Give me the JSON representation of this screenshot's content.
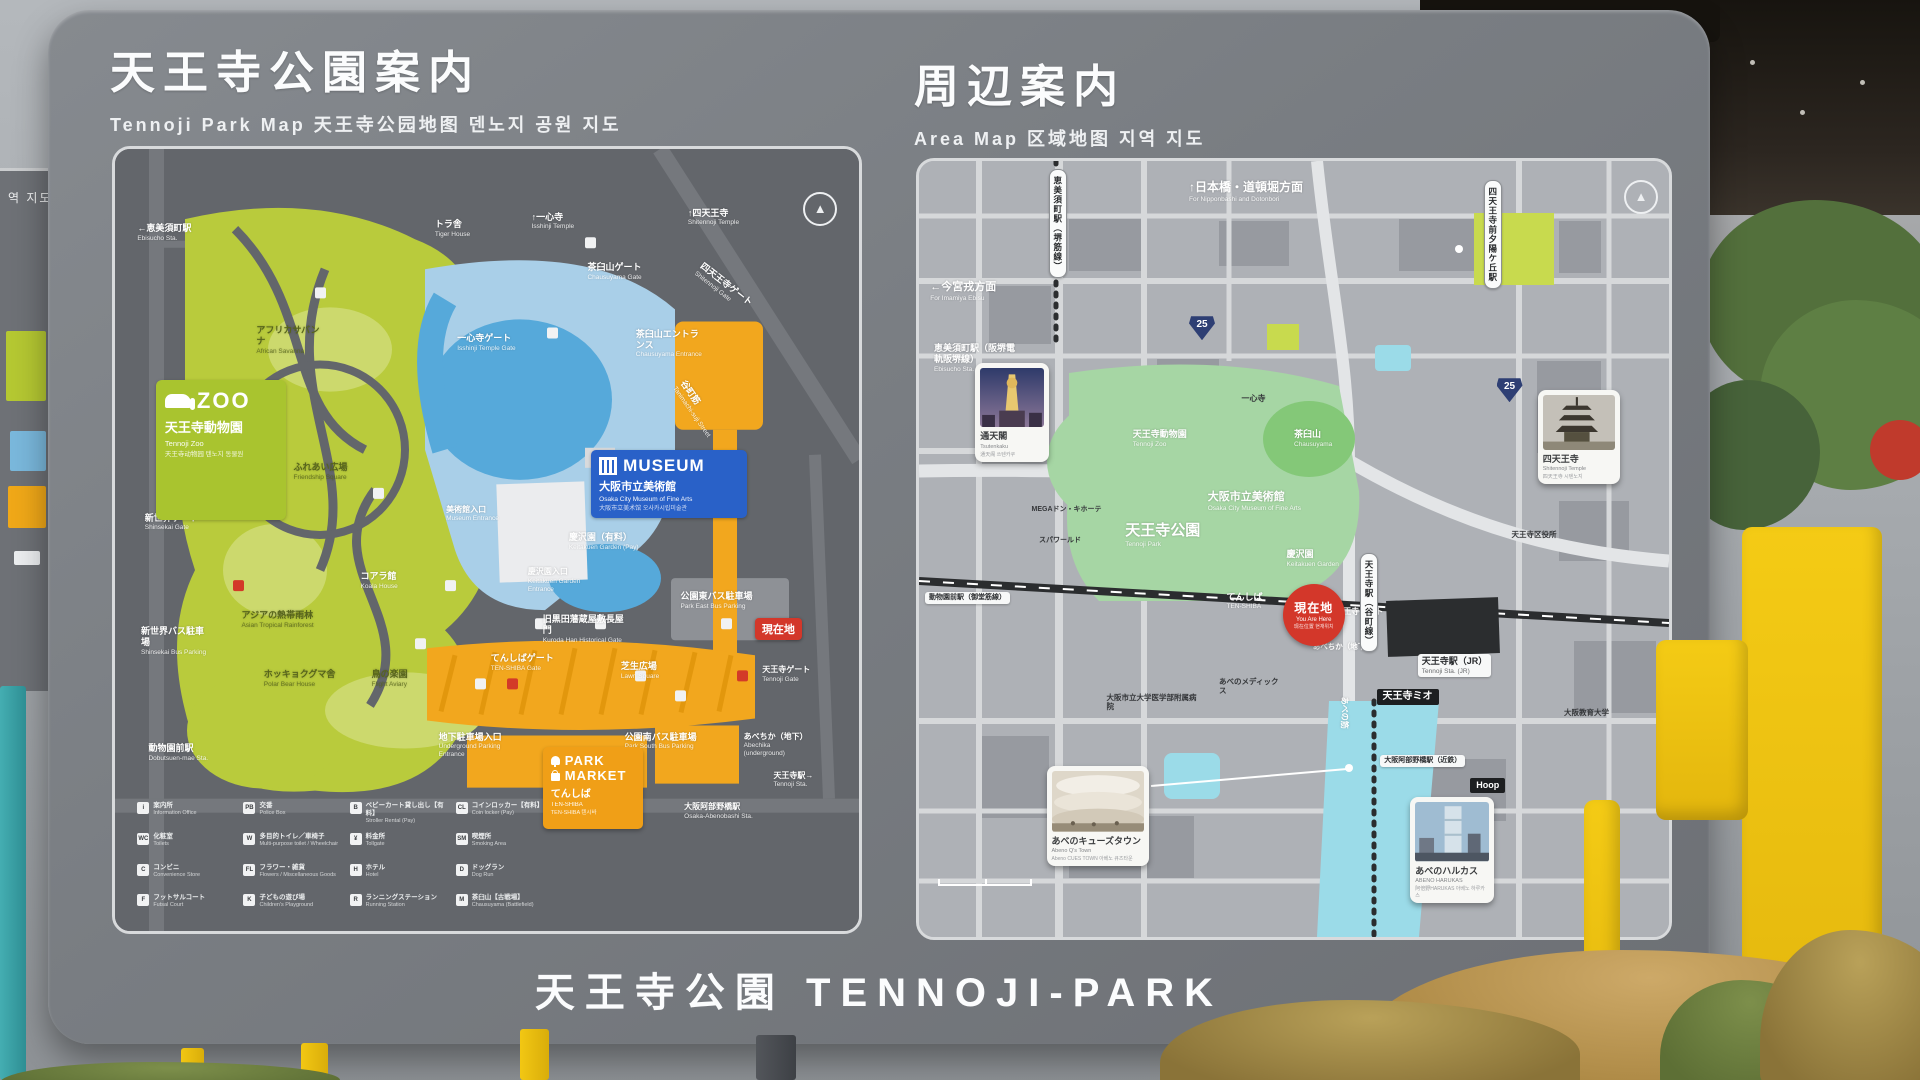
{
  "scene": {
    "left_fragment_text": "역 지도"
  },
  "board": {
    "footer": "天王寺公園  TENNOJI-PARK",
    "left": {
      "title": "天王寺公園案内",
      "subtitle": "Tennoji Park Map  天王寺公园地图  덴노지 공원 지도",
      "zoo_box": {
        "title": "ZOO",
        "ja": "天王寺動物園",
        "en": "Tennoji Zoo",
        "sub": "天王寺动物园  텐노지 동물원"
      },
      "museum_box": {
        "title": "MUSEUM",
        "ja": "大阪市立美術館",
        "en": "Osaka City Museum of Fine Arts",
        "sub": "大阪市立美术馆  오사카시립미술관"
      },
      "park_market": {
        "l1": "PARK",
        "l2": "MARKET",
        "ja": "てんしば",
        "en": "TEN-SHIBA",
        "sub": "TEN-SHIBA  텐시바"
      },
      "you_are_here": "現在地",
      "labels": [
        {
          "t": "←恵美須町駅",
          "s": "Ebisucho Sta.",
          "x": 3,
          "y": 9.5
        },
        {
          "t": "トラ舎",
          "s": "Tiger House",
          "x": 43,
          "y": 9
        },
        {
          "t": "↑一心寺",
          "s": "Isshinji Temple",
          "x": 56,
          "y": 8
        },
        {
          "t": "茶臼山ゲート",
          "s": "Chausuyama Gate",
          "x": 63.5,
          "y": 14.5
        },
        {
          "t": "↑四天王寺",
          "s": "Shitennoji Temple",
          "x": 77,
          "y": 7.5
        },
        {
          "t": "四天王寺ゲート",
          "s": "Shitennoji Gate",
          "x": 77.5,
          "y": 16.5,
          "rot": 38
        },
        {
          "t": "一心寺ゲート",
          "s": "Isshinji Temple Gate",
          "x": 46,
          "y": 23.5
        },
        {
          "t": "茶臼山エントランス",
          "s": "Chausuyama Entrance",
          "x": 70,
          "y": 23,
          "w": 68
        },
        {
          "t": "アフリカサバンナ",
          "s": "African Savanna",
          "x": 19,
          "y": 22.5,
          "c": "#57641c",
          "w": 70
        },
        {
          "t": "谷町筋",
          "s": "Tanimachi-suji Street",
          "x": 74,
          "y": 32,
          "rot": 55
        },
        {
          "t": "ふれあい広場",
          "s": "Friendship Square",
          "x": 24,
          "y": 40,
          "c": "#57641c"
        },
        {
          "t": "新世界ゲート",
          "s": "Shinsekai Gate",
          "x": 4,
          "y": 46.5
        },
        {
          "t": "美術館入口",
          "s": "Museum Entrance",
          "x": 44.5,
          "y": 45.5,
          "fs": 8
        },
        {
          "t": "慶沢園（有料）",
          "s": "Keitakuen Garden (Pay)",
          "x": 61,
          "y": 49,
          "w": 70
        },
        {
          "t": "慶沢園入口",
          "s": "Keitakuen Garden Entrance",
          "x": 55.5,
          "y": 53.5,
          "fs": 8,
          "w": 64
        },
        {
          "t": "コアラ館",
          "s": "Koala House",
          "x": 33,
          "y": 54
        },
        {
          "t": "公園東バス駐車場",
          "s": "Park East Bus Parking",
          "x": 76,
          "y": 56.5,
          "w": 72
        },
        {
          "t": "アジアの熱帯雨林",
          "s": "Asian Tropical Rainforest",
          "x": 17,
          "y": 59,
          "c": "#57641c",
          "w": 80
        },
        {
          "t": "旧黒田藩蔵屋敷長屋門",
          "s": "Kuroda Han Historical Gate",
          "x": 57.5,
          "y": 59.5,
          "w": 88
        },
        {
          "t": "新世界バス駐車場",
          "s": "Shinsekai Bus Parking",
          "x": 3.5,
          "y": 61,
          "w": 70
        },
        {
          "t": "ホッキョクグマ舎",
          "s": "Polar Bear House",
          "x": 20,
          "y": 66.5,
          "c": "#57641c",
          "w": 72
        },
        {
          "t": "鳥の楽園",
          "s": "Flight Aviary",
          "x": 34.5,
          "y": 66.5,
          "c": "#57641c"
        },
        {
          "t": "てんしばゲート",
          "s": "TEN-SHIBA Gate",
          "x": 50.5,
          "y": 64.5,
          "w": 64
        },
        {
          "t": "芝生広場",
          "s": "Lawn Square",
          "x": 68,
          "y": 65.5
        },
        {
          "t": "天王寺ゲート",
          "s": "Tennoji Gate",
          "x": 87,
          "y": 66,
          "fs": 8,
          "w": 52
        },
        {
          "t": "動物園前駅",
          "s": "Dobutsuen-mae Sta.",
          "x": 4.5,
          "y": 76
        },
        {
          "t": "地下駐車場入口",
          "s": "Underground Parking Entrance",
          "x": 43.5,
          "y": 74.5,
          "w": 82
        },
        {
          "t": "公園南バス駐車場",
          "s": "Park South Bus Parking",
          "x": 68.5,
          "y": 74.5,
          "w": 76
        },
        {
          "t": "あべちか（地下）",
          "s": "Abechika (underground)",
          "x": 84.5,
          "y": 74.5,
          "fs": 8,
          "w": 66
        },
        {
          "t": "天王寺駅→",
          "s": "Tennoji Sta.",
          "x": 88.5,
          "y": 79.5,
          "fs": 8
        },
        {
          "t": "大阪阿部野橋駅",
          "s": "Osaka-Abenobashi Sta.",
          "x": 76.5,
          "y": 83.5,
          "fs": 8,
          "w": 72
        }
      ],
      "legend": [
        {
          "g": "i",
          "t": "案内所",
          "s": "Information Office"
        },
        {
          "g": "WC",
          "t": "化粧室",
          "s": "Toilets"
        },
        {
          "g": "C",
          "t": "コンビニ",
          "s": "Convenience Store"
        },
        {
          "g": "F",
          "t": "フットサルコート",
          "s": "Futsal Court"
        },
        {
          "g": "PB",
          "t": "交番",
          "s": "Police Box"
        },
        {
          "g": "W",
          "t": "多目的トイレ／車椅子",
          "s": "Multi-purpose toilet / Wheelchair"
        },
        {
          "g": "FL",
          "t": "フラワー・雑貨",
          "s": "Flowers / Miscellaneous Goods"
        },
        {
          "g": "K",
          "t": "子どもの遊び場",
          "s": "Children's Playground"
        },
        {
          "g": "B",
          "t": "ベビーカート貸し出し【有料】",
          "s": "Stroller Rental (Pay)"
        },
        {
          "g": "¥",
          "t": "料金所",
          "s": "Tollgate"
        },
        {
          "g": "H",
          "t": "ホテル",
          "s": "Hotel"
        },
        {
          "g": "R",
          "t": "ランニングステーション",
          "s": "Running Station"
        },
        {
          "g": "CL",
          "t": "コインロッカー【有料】",
          "s": "Coin locker (Pay)"
        },
        {
          "g": "SM",
          "t": "喫煙所",
          "s": "Smoking Area"
        },
        {
          "g": "D",
          "t": "ドッグラン",
          "s": "Dog Run"
        },
        {
          "g": "M",
          "t": "茶臼山【古戦場】",
          "s": "Chausuyama (Battlefield)"
        }
      ]
    },
    "right": {
      "title": "周辺案内",
      "subtitle": "Area Map  区域地图  지역 지도",
      "you_are_here": {
        "ja": "現在地",
        "en": "You Are Here",
        "sub": "现在位置  현재위치"
      },
      "route_shield": "25",
      "stations": {
        "ebisucho": "恵美須町駅（堺筋線）",
        "tanimachi": "天王寺駅（谷町線）",
        "shitennoji_mae": "四天王寺前夕陽ケ丘駅"
      },
      "labels": [
        {
          "t": "↑日本橋・道頓堀方面",
          "s": "For Nipponbashi and Dotonbori",
          "x": 36,
          "y": 2.5,
          "fs": 12
        },
        {
          "t": "←今宮戎方面",
          "s": "For Imamiya Ebisu",
          "x": 1.5,
          "y": 15.5,
          "fs": 11
        },
        {
          "t": "恵美須町駅（阪堺電軌阪堺線）",
          "s": "Ebisucho Sta.",
          "x": 2,
          "y": 23.5,
          "w": 86
        },
        {
          "t": "新世界",
          "s": "Shinsekai",
          "x": 12,
          "y": 30.5,
          "fs": 12
        },
        {
          "t": "一心寺",
          "x": 43,
          "y": 30,
          "cls": "blk",
          "fs": 8
        },
        {
          "t": "天王寺動物園",
          "s": "Tennoji Zoo",
          "x": 28.5,
          "y": 34.5
        },
        {
          "t": "茶臼山",
          "s": "Chausuyama",
          "x": 50,
          "y": 34.5
        },
        {
          "t": "大阪市立美術館",
          "s": "Osaka City Museum of Fine Arts",
          "x": 38.5,
          "y": 42.5,
          "fs": 11,
          "w": 120
        },
        {
          "t": "天王寺公園",
          "s": "Tennoji Park",
          "x": 27.5,
          "y": 46.5,
          "fs": 15
        },
        {
          "t": "慶沢園",
          "s": "Keitakuen Garden",
          "x": 49,
          "y": 50
        },
        {
          "t": "MEGAドン・キホーテ",
          "x": 15,
          "y": 44.5,
          "cls": "blk",
          "fs": 7,
          "w": 70
        },
        {
          "t": "スパワールド",
          "x": 16,
          "y": 48.5,
          "cls": "blk",
          "fs": 7
        },
        {
          "t": "てんしば",
          "s": "TEN-SHIBA",
          "x": 41,
          "y": 55.5
        },
        {
          "t": "天王寺ゲート",
          "x": 55.5,
          "y": 57.5,
          "fs": 8
        },
        {
          "t": "動物園前駅（御堂筋線）",
          "x": 0.8,
          "y": 55.5,
          "cls": "whitebox",
          "fs": 7
        },
        {
          "t": "あべちか（地下）",
          "x": 52.5,
          "y": 62,
          "fs": 7.5
        },
        {
          "t": "天王寺駅（JR）",
          "s": "Tennoji Sta. (JR)",
          "x": 66.5,
          "y": 63.5,
          "cls": "whitebox",
          "fs": 9
        },
        {
          "t": "天王寺ミオ",
          "x": 61,
          "y": 68,
          "cls": "blackbox",
          "fs": 10
        },
        {
          "t": "大阪市立大学医学部附属病院",
          "x": 25,
          "y": 68.5,
          "cls": "blk",
          "fs": 7.5,
          "w": 92
        },
        {
          "t": "あべのメディックス",
          "x": 40,
          "y": 66.5,
          "cls": "blk",
          "fs": 7.5,
          "w": 64
        },
        {
          "t": "あべの筋",
          "x": 54.5,
          "y": 70.5,
          "rot": 90,
          "fs": 8
        },
        {
          "t": "大阪阿部野橋駅（近鉄）",
          "x": 61.5,
          "y": 76.5,
          "cls": "whitebox",
          "fs": 7
        },
        {
          "t": "Hoop",
          "x": 73.5,
          "y": 79.5,
          "cls": "blackbox",
          "fs": 9
        },
        {
          "t": "and",
          "x": 71.5,
          "y": 86.5,
          "cls": "blackbox",
          "fs": 9
        },
        {
          "t": "天王寺区役所",
          "x": 79,
          "y": 47.5,
          "cls": "blk",
          "fs": 7.5
        },
        {
          "t": "大阪教育大学",
          "x": 86,
          "y": 70.5,
          "cls": "blk",
          "fs": 7.5
        }
      ],
      "cards": [
        {
          "ja": "通天閣",
          "en": "Tsutenkaku",
          "sub": "通天阁  쓰텐카쿠"
        },
        {
          "ja": "四天王寺",
          "en": "Shitennoji Temple",
          "sub": "四天王寺  시텐노지"
        },
        {
          "ja": "あべのキューズタウン",
          "en": "Abeno Q's Town",
          "sub": "Abeno CUES TOWN  아베노 큐즈타운"
        },
        {
          "ja": "あべのハルカス",
          "en": "ABENO HARUKAS",
          "sub": "阿倍野HARUKAS  아베노 하루카스"
        }
      ]
    }
  }
}
